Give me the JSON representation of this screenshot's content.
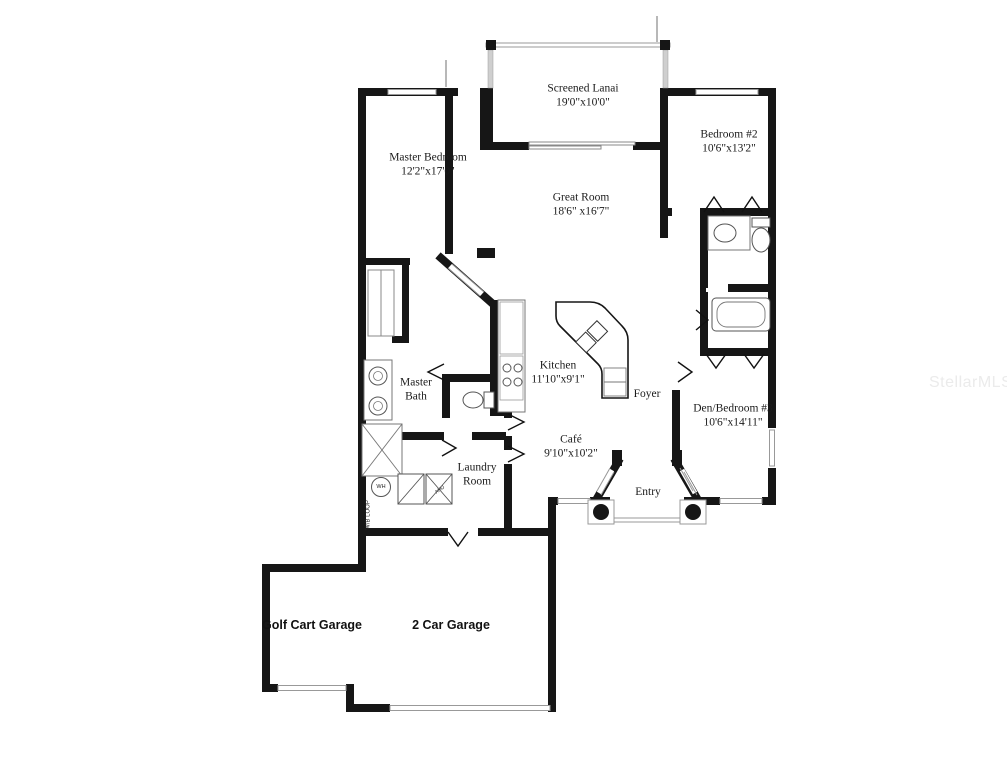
{
  "watermark": "StellarMLS",
  "rooms": {
    "screened_lanai": {
      "name": "Screened Lanai",
      "dims": "19'0\"x10'0\""
    },
    "master_bedroom": {
      "name": "Master Bedroom",
      "dims": "12'2\"x17'0\""
    },
    "bedroom_2": {
      "name": "Bedroom #2",
      "dims": "10'6\"x13'2\""
    },
    "great_room": {
      "name": "Great Room",
      "dims": "18'6\" x16'7\""
    },
    "kitchen": {
      "name": "Kitchen",
      "dims": "11'10\"x9'1\""
    },
    "master_bath": {
      "name": "Master Bath"
    },
    "foyer": {
      "name": "Foyer"
    },
    "den_bedroom_3": {
      "name": "Den/Bedroom #3",
      "dims": "10'6\"x14'11\""
    },
    "cafe": {
      "name": "Café",
      "dims": "9'10\"x10'2\""
    },
    "laundry": {
      "name": "Laundry Room"
    },
    "entry": {
      "name": "Entry"
    },
    "golf_cart_garage": {
      "name": "Golf Cart Garage"
    },
    "two_car_garage": {
      "name": "2 Car Garage"
    }
  },
  "equipment": {
    "water_heater": "WH",
    "air_handler": "AHU",
    "wb_loop": "W/B LOOP"
  },
  "colors": {
    "wall": "#161616",
    "fixture_line": "#777777",
    "window_line": "#999999",
    "watermark": "#ebebeb"
  }
}
